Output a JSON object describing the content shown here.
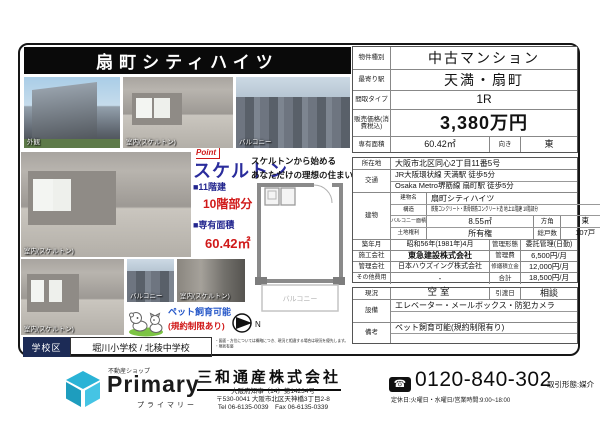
{
  "colors": {
    "accent_red": "#d01818",
    "accent_navy": "#23268f",
    "school_navy": "#1c2b56",
    "brand_cyan": "#2ab3d6"
  },
  "title": "扇町シティハイツ",
  "photos": {
    "exterior": "外観",
    "interior_top": "室内(スケルトン)",
    "balcony_top": "バルコニー",
    "interior_mid": "室内(スケルトン)",
    "interior_bottom": "室内(スケルトン)",
    "balcony_small": "バルコニー",
    "interior_small": "室内(スケルトン)"
  },
  "point": {
    "badge": "Point",
    "headline": "スケルトン",
    "copy_line1": "スケルトンから始める",
    "copy_line2": "あなただけの理想の住まい",
    "floors_label": "■11階建",
    "floors_value": "10階部分",
    "area_label": "■専有面積",
    "area_value": "60.42㎡",
    "plan_label": "■PLAN",
    "plan_value": "1R"
  },
  "floorplan": {
    "balcony": "バルコニー",
    "north": "N"
  },
  "pet": {
    "main": "ペット飼育可能",
    "sub": "(規約制限あり)"
  },
  "school": {
    "label": "学校区",
    "value": "堀川小学校  /  北稜中学校"
  },
  "notes": {
    "line1": "・図面・方位については概略につき、現況と相違する場合は現況を優先します。",
    "line2": "・現状有姿"
  },
  "spec": {
    "property_type_label": "物件種別",
    "property_type": "中古マンション",
    "station_label": "最寄り駅",
    "station": "天満・扇町",
    "layout_label": "間取タイプ",
    "layout": "1R",
    "price_label": "販売価格(消費税込)",
    "price": "3,380万円",
    "area_label": "専有面積",
    "area": "60.42㎡",
    "facing_label": "向き",
    "facing": "東",
    "address_label": "所在地",
    "address": "大阪市北区同心2丁目11番5号",
    "access_label": "交通",
    "access_line1": "JR大阪環状線 天満駅 徒歩5分",
    "access_line2": "Osaka Metro堺筋線 扇町駅 徒歩5分",
    "building_label": "建物",
    "building_name_label": "建物名",
    "building_name": "扇町シティハイツ",
    "structure_label": "構造",
    "structure": "鉄筋コンクリート・鉄骨鉄筋コンクリート造 地上11階建 10階部分",
    "balcony_area_label": "バルコニー面積",
    "balcony_area": "8.55㎡",
    "direction_label": "方角",
    "direction": "東",
    "land_label": "土地権利",
    "land": "所有権",
    "units_label": "総戸数",
    "units": "107戸",
    "built_label": "築年月",
    "built": "昭和56年(1981年)4月",
    "mgmt_style_label": "管理形態",
    "mgmt_style": "委託管理(日勤)",
    "contractor_label": "施工会社",
    "contractor": "東急建設株式会社",
    "mgmt_fee_label": "管理費",
    "mgmt_fee": "6,500円/月",
    "mgmt_company_label": "管理会社",
    "mgmt_company": "日本ハウズイング株式会社",
    "reserve_label": "修繕積立金",
    "reserve": "12,000円/月",
    "other_label": "その他費用",
    "other": "-",
    "total_label": "合計",
    "total": "18,500円/月",
    "status_label": "現況",
    "status": "空室",
    "handover_label": "引渡日",
    "handover": "相談",
    "facilities_label": "設備",
    "facilities": "エレベーター・メールボックス・防犯カメラ",
    "remarks_label": "備考",
    "remarks": "ペット飼育可能(規約制限有り)"
  },
  "footer": {
    "shop_tag": "不動産ショップ",
    "brand": "Primary",
    "brand_kana": "プライマリー",
    "company": "三和通産株式会社",
    "license": "大阪府知事〔14〕第14234号",
    "address": "〒530-0041 大阪市北区天神橋3丁目2-8",
    "telfax": "Tel 06-6135-0039　Fax 06-6135-0339",
    "phone_icon": "☎",
    "phone": "0120-840-302",
    "hours": "定休日:火曜日・水曜日/営業時間:9:00~18:00",
    "deal": "取引形態:媒介"
  }
}
